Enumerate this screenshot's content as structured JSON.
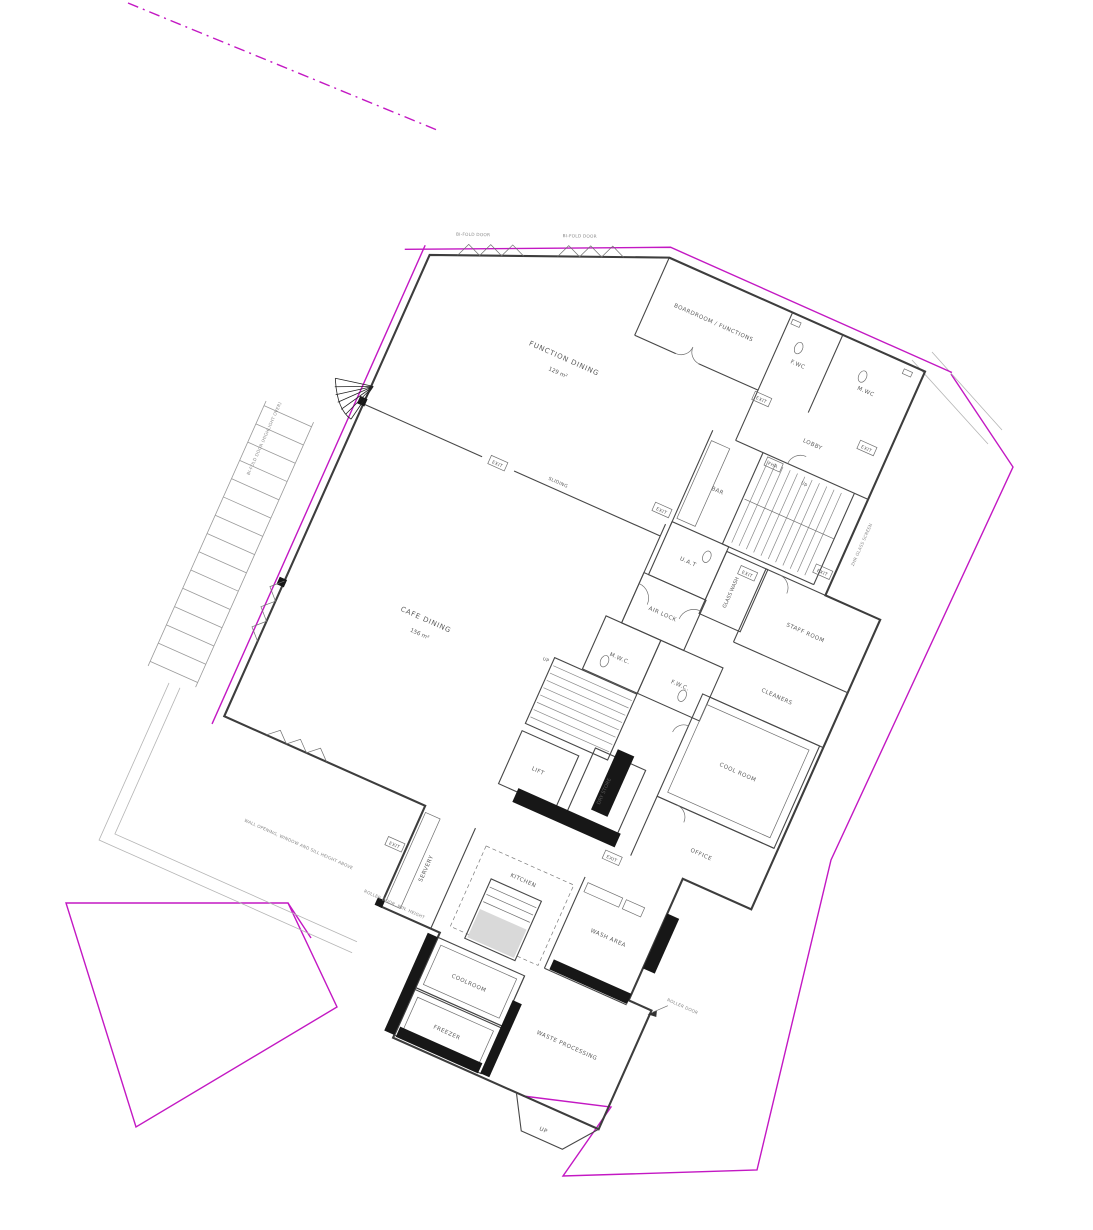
{
  "drawing": {
    "kind": "architectural ground floor plan",
    "colors": {
      "boundary": "#c318c3",
      "wall": "#474747",
      "wall_fill": "#171717",
      "label": "#5a5a5a"
    }
  },
  "rooms": {
    "function_dining": {
      "label": "FUNCTION DINING",
      "area": "129 m²"
    },
    "cafe_dining": {
      "label": "CAFE DINING",
      "area": "156 m²"
    },
    "boardroom": {
      "label": "BOARDROOM / FUNCTIONS"
    },
    "fwc_top": {
      "label": "F.WC"
    },
    "mwc_top": {
      "label": "M.WC"
    },
    "lobby": {
      "label": "LOBBY"
    },
    "bar": {
      "label": "BAR"
    },
    "staff_room": {
      "label": "STAFF ROOM"
    },
    "cleaners": {
      "label": "CLEANERS"
    },
    "cool_room": {
      "label": "COOL ROOM"
    },
    "office": {
      "label": "OFFICE"
    },
    "uat": {
      "label": "U.A.T"
    },
    "glass_wash": {
      "label": "GLASS WASH"
    },
    "air_lock": {
      "label": "AIR LOCK"
    },
    "mwc_core": {
      "label": "M.W.C."
    },
    "fwc_core": {
      "label": "F.W.C."
    },
    "lift": {
      "label": "LIFT"
    },
    "dry_store": {
      "label": "DRY STORE"
    },
    "servery": {
      "label": "SERVERY"
    },
    "kitchen": {
      "label": "KITCHEN"
    },
    "wash_area": {
      "label": "WASH AREA"
    },
    "coolroom": {
      "label": "COOLROOM"
    },
    "freezer": {
      "label": "FREEZER"
    },
    "waste_processing": {
      "label": "WASTE PROCESSING"
    }
  },
  "badges": {
    "exit": "EXIT",
    "fhr": "FHR",
    "up": "Up",
    "up_ramp": "UP",
    "sliding": "SLIDING"
  },
  "notes": {
    "bifold_1": "BI-FOLD DOOR",
    "bifold_2": "BI-FOLD DOOR",
    "bifold_3": "BI-FOLD DOOR (HIGHLIGHT OVER)",
    "window_note": "WALL OPENING, WINDOW AND SILL HEIGHT ABOVE",
    "roller_note": "ROLLER DOOR, MIN. HEIGHT",
    "roller_note_2": "ROLLER DOOR",
    "glass_note": "2HR GLASS SCREEN"
  }
}
